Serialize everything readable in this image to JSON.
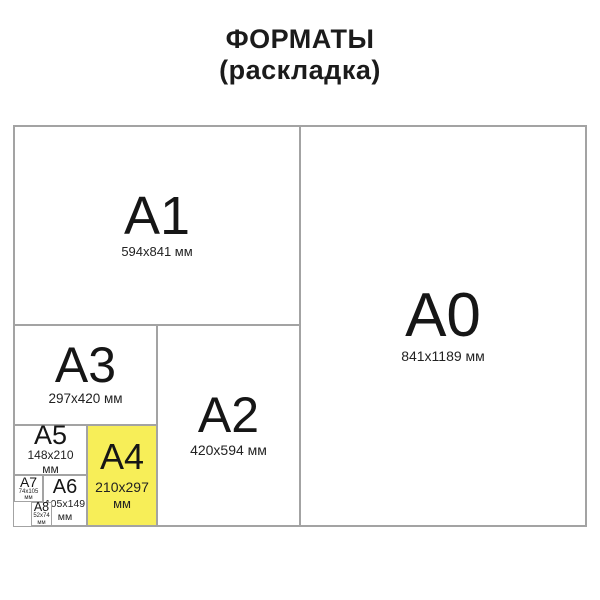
{
  "title": {
    "line1": "ФОРМАТЫ",
    "line2": "(раскладка)"
  },
  "colors": {
    "highlight": "#F7EE58",
    "border": "#A3A3A3",
    "text": "#1A1A1A",
    "background": "#FFFFFF"
  },
  "formats": {
    "a0": {
      "label": "A0",
      "size": "841x1189 мм"
    },
    "a1": {
      "label": "A1",
      "size": "594x841 мм"
    },
    "a2": {
      "label": "A2",
      "size": "420x594 мм"
    },
    "a3": {
      "label": "A3",
      "size": "297x420 мм"
    },
    "a4": {
      "label": "A4",
      "size": "210x297",
      "unit": "мм",
      "highlighted": true
    },
    "a5": {
      "label": "A5",
      "size": "148x210",
      "unit": "мм"
    },
    "a6": {
      "label": "A6",
      "size": "105x149",
      "unit": "мм"
    },
    "a7": {
      "label": "A7",
      "size": "74x105",
      "unit": "мм"
    },
    "a8": {
      "label": "A8",
      "size": "52x74",
      "unit": "мм"
    }
  }
}
